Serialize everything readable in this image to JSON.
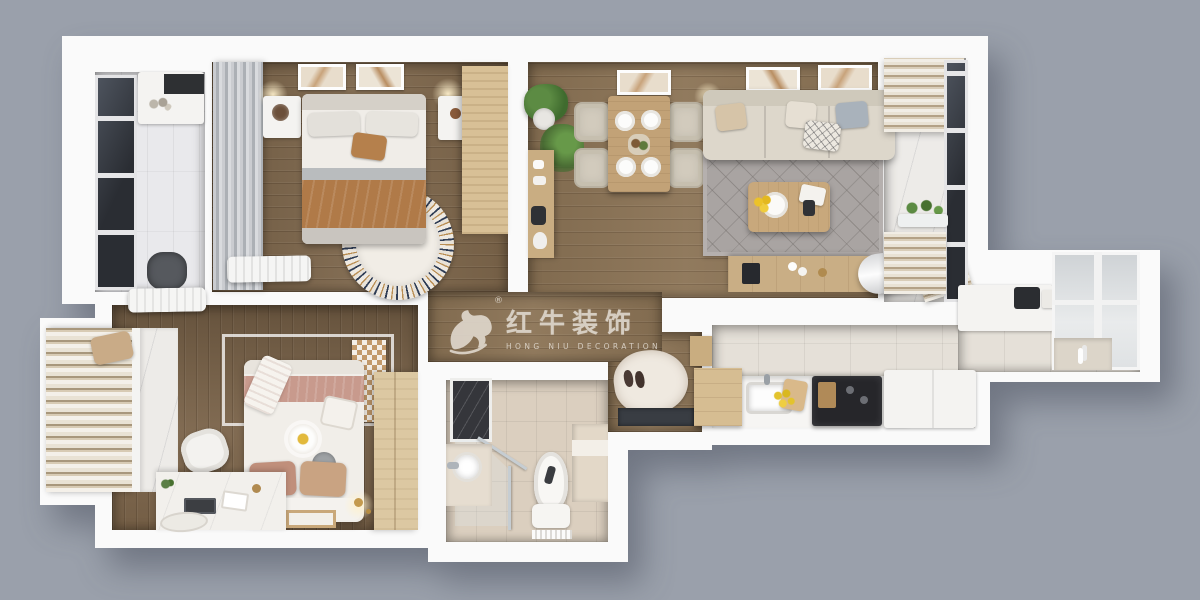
{
  "watermark": {
    "logo_icon": "bull-icon",
    "registered_symbol": "®",
    "brand_name_cn": "红牛装饰",
    "brand_name_en": "HONG NIU DECORATION"
  },
  "palette": {
    "background": "#9aa0ab",
    "walls": "#fafafa",
    "wood_floor_living": "#8b7355",
    "wood_floor_bedroom1": "#7c654a",
    "wood_floor_bedroom2": "#7a6349",
    "kitchen_tile": "#e5e0d8",
    "bathroom_tile": "#dbcfbf",
    "balcony_marble": "#edebe8",
    "rug_gray": "#a9a4a2",
    "sofa_beige": "#ddd7cb",
    "furniture_wood": "#c2a277",
    "wardrobe_tan": "#d8c096",
    "blanket_brown": "#b07a48",
    "bedding_pink": "#c89a8d",
    "window_frame_dark": "#2a2d33",
    "plant_green": "#567f3e",
    "lemon_yellow": "#e3c32d",
    "watermark_text": "#ded6cb"
  }
}
